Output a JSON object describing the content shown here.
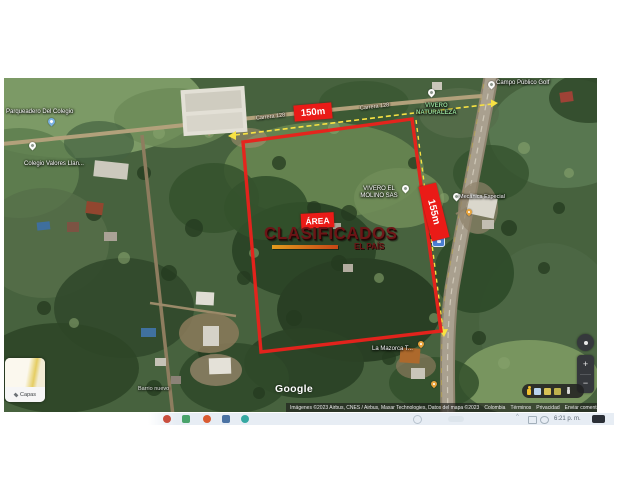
{
  "colors": {
    "annotation_red": "#ea1b17",
    "measure_yellow": "#f7e243",
    "watermark_red": "#701316"
  },
  "map": {
    "google_logo": "Google",
    "layers_label": "Capas",
    "controls": {
      "zoom_in": "+",
      "zoom_out": "−"
    },
    "annotations": {
      "width_label": "150m",
      "height_label": "155m",
      "area_label": "ÁREA"
    },
    "watermark": {
      "title": "CLASIFICADOS",
      "subtitle": "EL PAÍS"
    },
    "road_labels": [
      "Carrera 128",
      "Carrera 128"
    ],
    "pois": {
      "parqueadero": "Parqueadero Del Colegio",
      "colegio": "Colegio Valores Llan...",
      "golf": "Campo Público Golf",
      "vivero_nat_line1": "VIVERO",
      "vivero_nat_line2": "NATURALEZA",
      "molino_line1": "VIVERO EL",
      "molino_line2": "MOLINO SAS",
      "mecanica": "Mecánica Especial",
      "mazorca": "La Mazorca T...",
      "barrio": "Barrio nuevo"
    },
    "attribution": {
      "imagery": "Imágenes ©2023 Airbus, CNES / Airbus, Maxar Technologies, Datos del mapa ©2023",
      "links": [
        "Colombia",
        "Términos",
        "Privacidad",
        "Enviar comentarios"
      ],
      "scale": "20 m"
    }
  },
  "taskbar": {
    "time": "6:21 p. m."
  }
}
